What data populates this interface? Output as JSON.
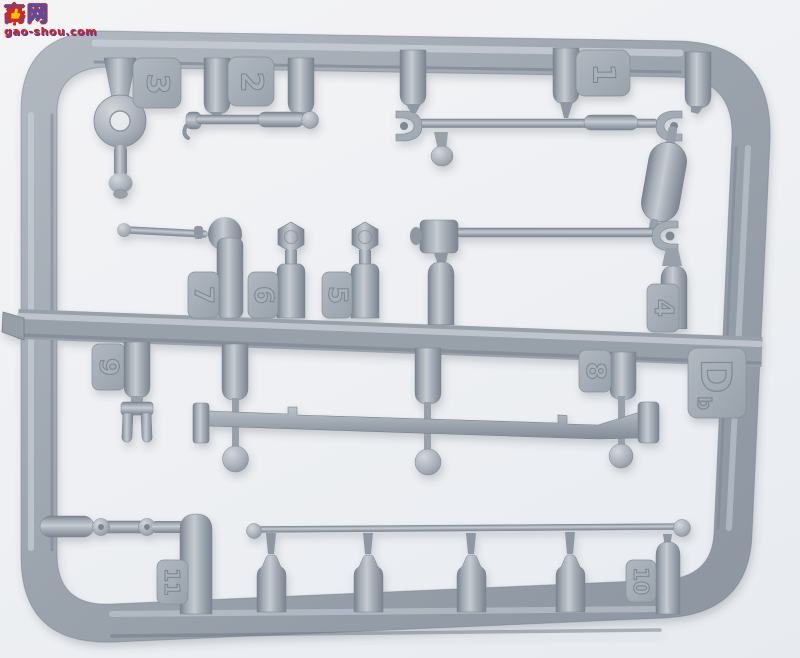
{
  "photo": {
    "subject": "grey injection-moulded plastic model kit sprue with numbered parts",
    "background_color": "#eef0f3",
    "plastic_color": "#9aa2ac",
    "plastic_highlight": "#c6cbd2",
    "plastic_shadow": "#79828e"
  },
  "watermark": {
    "char_left": "高",
    "char_right": "网",
    "gear_icon": "gear-thumb-logo",
    "domain": "gao-shou.com",
    "red": "#df231a",
    "blue": "#3c55c0"
  },
  "sprue": {
    "letter": "D",
    "cavity_mark": "b",
    "tags": {
      "1": "1",
      "2": "2",
      "3": "3",
      "4": "4",
      "5": "5",
      "6": "6",
      "7": "7",
      "8": "8",
      "9": "9",
      "10": "10",
      "11": "11"
    }
  }
}
